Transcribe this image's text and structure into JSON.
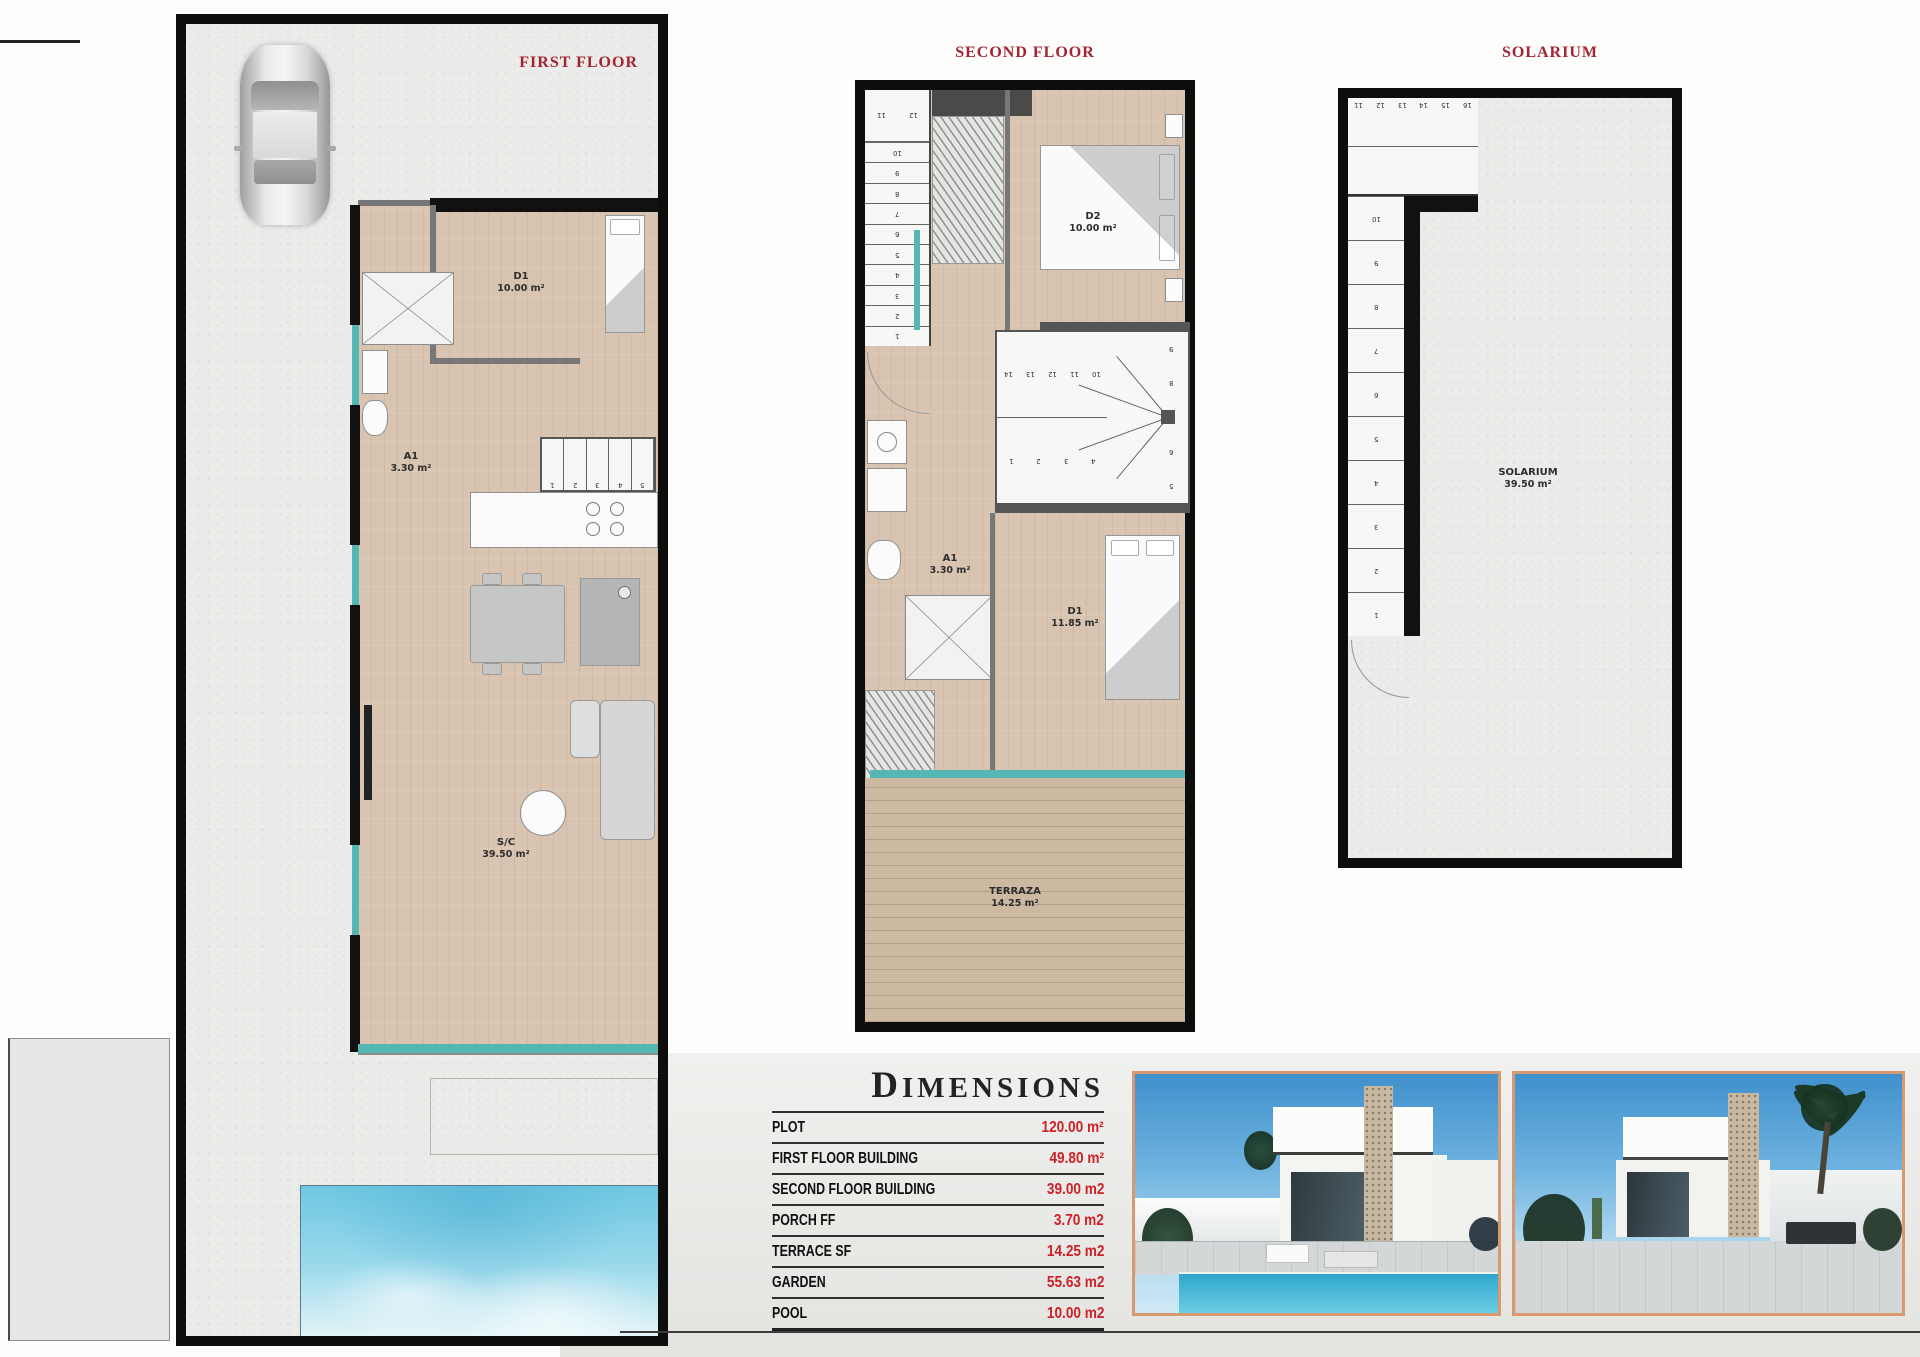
{
  "colors": {
    "title_red": "#a32433",
    "value_red": "#cd2127",
    "wall_black": "#0d0d0d",
    "wood_floor": "#d8c4b0",
    "deck_wood": "#cdb8a2",
    "window_teal": "#55b7b3",
    "pool_blue": "#6ec7e2",
    "photo_border": "#d8996f"
  },
  "plans": {
    "first": {
      "title": "FIRST FLOOR",
      "bedroom": {
        "name": "D1",
        "area": "10.00 m²"
      },
      "bath": {
        "name": "A1",
        "area": "3.30 m²"
      },
      "living": {
        "name": "S/C",
        "area": "39.50 m²"
      },
      "stair_numbers": [
        "1",
        "2",
        "3",
        "4",
        "5"
      ]
    },
    "second": {
      "title": "SECOND FLOOR",
      "bedroom2": {
        "name": "D2",
        "area": "10.00 m²"
      },
      "bath": {
        "name": "A1",
        "area": "3.30 m²"
      },
      "bedroom1": {
        "name": "D1",
        "area": "11.85 m²"
      },
      "terrace": {
        "name": "TERRAZA",
        "area": "14.25 m²"
      },
      "stairs_from_ff_top": [
        "11",
        "12"
      ],
      "stairs_from_ff": [
        "10",
        "9",
        "8",
        "7",
        "6",
        "5",
        "4",
        "3",
        "2",
        "1"
      ],
      "stairs_to_solarium_upper": [
        "14",
        "13",
        "12",
        "11",
        "10"
      ],
      "stairs_to_solarium_side": [
        "9",
        "8",
        "7",
        "6",
        "5"
      ],
      "stairs_to_solarium_lower": [
        "1",
        "2",
        "3",
        "4"
      ]
    },
    "solarium": {
      "title": "SOLARIUM",
      "room": {
        "name": "SOLARIUM",
        "area": "39.50 m²"
      },
      "stairs_top": [
        "11",
        "12",
        "13",
        "14",
        "15",
        "16"
      ],
      "stairs_side": [
        "10",
        "9",
        "8",
        "7",
        "6",
        "5",
        "4",
        "3",
        "2",
        "1"
      ]
    }
  },
  "dimensions": {
    "title": "DIMENSIONS",
    "rows": [
      {
        "label": "PLOT",
        "value": "120.00 m²"
      },
      {
        "label": "FIRST FLOOR BUILDING",
        "value": "49.80 m²"
      },
      {
        "label": "SECOND FLOOR BUILDING",
        "value": "39.00 m2"
      },
      {
        "label": "PORCH FF",
        "value": "3.70 m2"
      },
      {
        "label": "TERRACE SF",
        "value": "14.25 m2"
      },
      {
        "label": "GARDEN",
        "value": "55.63 m2"
      },
      {
        "label": "POOL",
        "value": "10.00 m2"
      }
    ]
  }
}
